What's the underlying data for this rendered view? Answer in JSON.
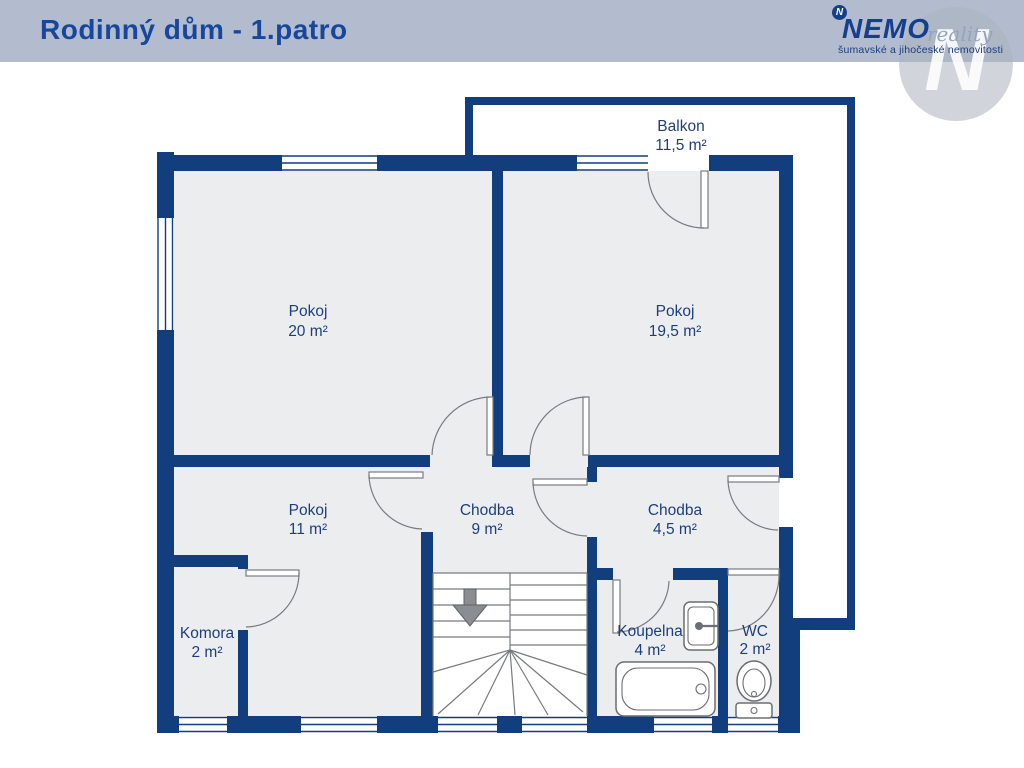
{
  "header": {
    "title": "Rodinný dům - 1.patro"
  },
  "logo": {
    "icon_letter": "N",
    "brand": "NEMO",
    "brand_suffix": "reality",
    "tagline": "šumavské a jihočeské nemovitosti",
    "watermark_letter": "N"
  },
  "plan": {
    "floor": "1.patro",
    "rooms": [
      {
        "key": "balkon",
        "name": "Balkon",
        "area": "11,5 m²"
      },
      {
        "key": "pokoj-20",
        "name": "Pokoj",
        "area": "20 m²"
      },
      {
        "key": "pokoj-19-5",
        "name": "Pokoj",
        "area": "19,5 m²"
      },
      {
        "key": "pokoj-11",
        "name": "Pokoj",
        "area": "11 m²"
      },
      {
        "key": "chodba-9",
        "name": "Chodba",
        "area": "9 m²"
      },
      {
        "key": "chodba-4-5",
        "name": "Chodba",
        "area": "4,5 m²"
      },
      {
        "key": "komora",
        "name": "Komora",
        "area": "2 m²"
      },
      {
        "key": "koupelna",
        "name": "Koupelna",
        "area": "4 m²"
      },
      {
        "key": "wc",
        "name": "WC",
        "area": "2 m²"
      }
    ]
  },
  "colors": {
    "wall": "#123e7d",
    "room_fill": "#ecedef",
    "header_bg": "#b2bcce",
    "title_text": "#17479c",
    "label_text": "#1d3e7c",
    "brand_blue": "#153f8c",
    "reality_gray": "#97a3bd",
    "watermark_gray": "#aab2be",
    "stair_arrow": "#8a8d91"
  }
}
